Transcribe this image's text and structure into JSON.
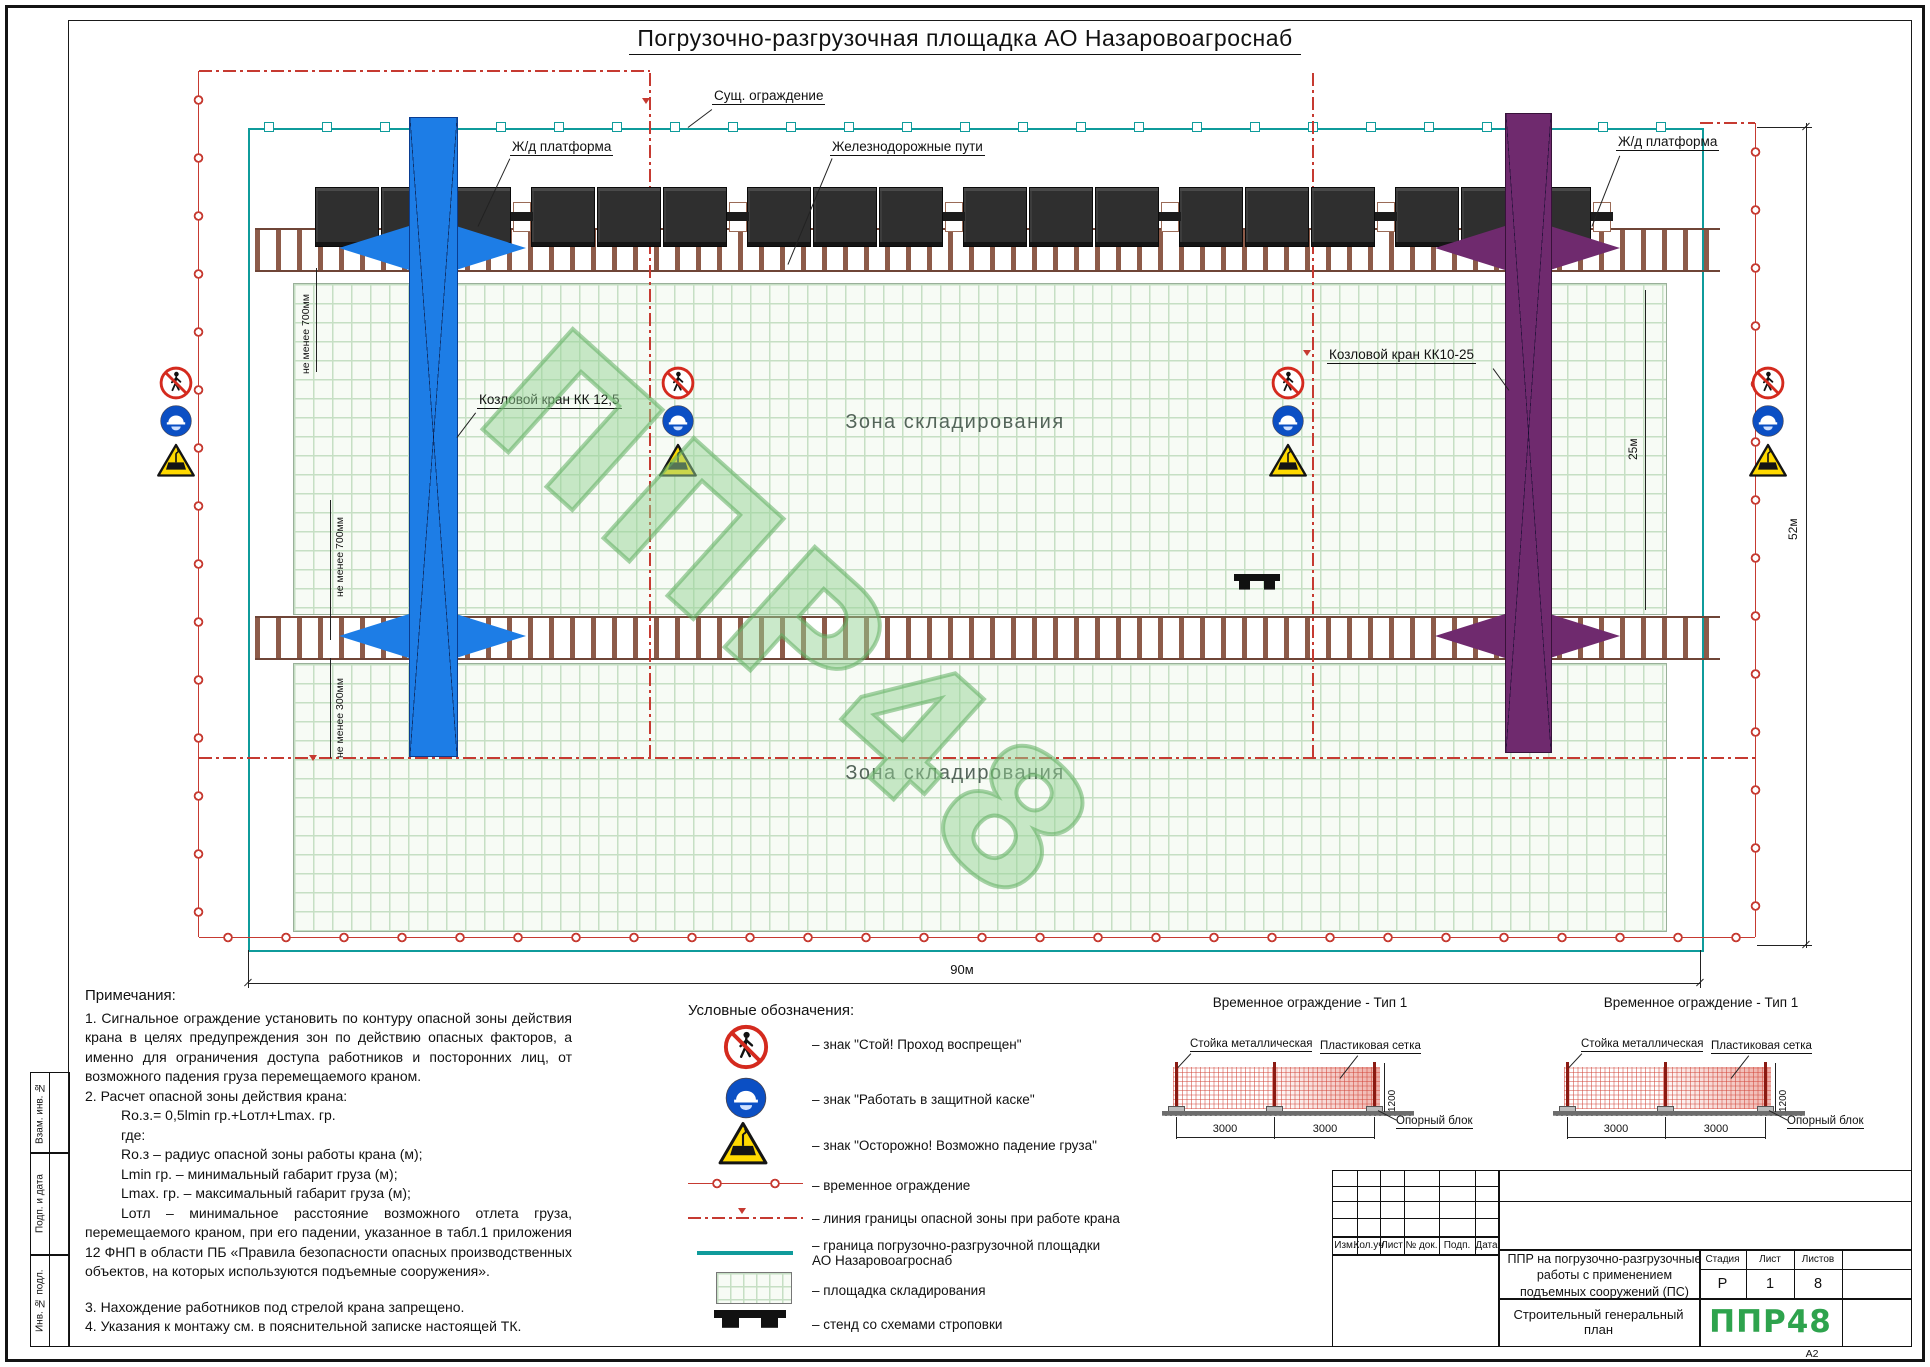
{
  "title": "Погрузочно-разгрузочная площадка АО Назаровоагроснаб",
  "plan": {
    "labels": {
      "existing_fence": "Сущ. ограждение",
      "rail_platform_left": "Ж/д платформа",
      "railways": "Железнодорожные пути",
      "rail_platform_right": "Ж/д платформа",
      "crane_left": "Козловой кран КК 12,5",
      "crane_right": "Козловой кран КК10-25",
      "storage_upper": "Зона складирования",
      "storage_lower": "Зона складирования"
    },
    "dims": {
      "min700_a": "не менее 700мм",
      "min700_b": "не менее 700мм",
      "min300": "не менее 300мм",
      "width": "90м",
      "height": "52м",
      "span": "25м"
    },
    "watermark": "ППР48"
  },
  "notes": {
    "heading": "Примечания:",
    "lines": [
      "1. Сигнальное ограждение установить по контуру опасной зоны действия крана в целях предупреждения зон по действию опасных факторов, а именно для ограничения доступа работников и посторонних лиц, от возможного падения груза перемещаемого краном.",
      "2. Расчет опасной зоны действия крана:",
      "Ro.з.= 0,5lmin гр.+Lотл+Lmax. гр.",
      "где:",
      "Ro.з – радиус опасной зоны работы крана (м);",
      "Lmin гр. – минимальный габарит груза (м);",
      "Lmax. гр. – максимальный габарит груза (м);",
      "Lотл – минимальное расстояние возможного отлета груза, перемещаемого краном, при его падении, указанное в табл.1 приложения 12 ФНП в области ПБ «Правила безопасности опасных производственных объектов, на которых используются подъемные сооружения».",
      "3. Нахождение работников под стрелой крана запрещено.",
      "4. Указания к монтажу см. в пояснительной записке настоящей ТК."
    ]
  },
  "legend": {
    "heading": "Условные обозначения:",
    "items": [
      "– знак \"Стой! Проход воспрещен\"",
      "– знак \"Работать в защитной каске\"",
      "– знак \"Осторожно! Возможно падение груза\"",
      "– временное ограждение",
      "– линия границы опасной зоны при работе крана",
      "– граница погрузочно-разгрузочной площадки АО Назаровоагроснаб",
      "– площадка складирования",
      "– стенд со схемами строповки"
    ]
  },
  "fence_detail": {
    "title": "Временное ограждение - Тип 1",
    "post_label": "Стойка металлическая",
    "mesh_label": "Пластиковая сетка",
    "block_label": "Опорный блок",
    "dim_a": "3000",
    "dim_b": "3000",
    "dim_h": "1200"
  },
  "title_block": {
    "rev_headers": [
      "Изм.",
      "Кол.уч",
      "Лист",
      "№ док.",
      "Подп.",
      "Дата"
    ],
    "doc_title": "ППР на погрузочно-разгрузочные работы с применением подъемных сооружений (ПС)",
    "stage_label": "Стадия",
    "sheet_label": "Лист",
    "sheets_label": "Листов",
    "stage": "Р",
    "sheet": "1",
    "sheets": "8",
    "drawing_name": "Строительный генеральный план",
    "logo": "ППР48",
    "format": "А2"
  },
  "side_strip": [
    "Взам. инв. №",
    "Подп. и дата",
    "Инв. № подл."
  ],
  "colors": {
    "site_boundary_teal": "#0f9b9b",
    "danger_red": "#c63a31",
    "crane_blue": "#1d7de6",
    "crane_purple": "#6f2a6e",
    "logo_green": "#2ea34d",
    "watermark_green": "#8dcf8d"
  }
}
